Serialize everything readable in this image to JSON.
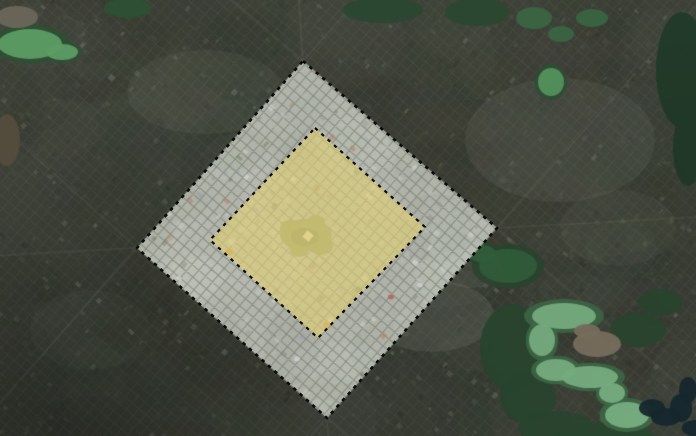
{
  "view": {
    "width": 696,
    "height": 436
  },
  "palette": {
    "base": "#3c4037",
    "base_mottle": [
      "#31352b",
      "#474b41",
      "#3a4434",
      "#4c483c",
      "#2c3028",
      "#555a50",
      "#434735"
    ],
    "outside_speckle": [
      "#4b5045",
      "#41463c",
      "#565b50",
      "#353a30",
      "#60655a",
      "#2d322a",
      "#50544a",
      "#474b41",
      "#7a7e72",
      "#3e4a3a"
    ],
    "street_outside": "rgba(160,164,152,0.10)",
    "avenue": "rgba(168,171,158,0.10)",
    "light_patch": "#a3a79a",
    "ring_fill": "#b0b4aa",
    "ring_mottle": [
      "#c6cabf",
      "#a3a79b",
      "#d2d5cc",
      "#969a8e"
    ],
    "ring_speckle": [
      "#d7d9d1",
      "#c6c9c0",
      "#b7bab0",
      "#9da196",
      "#8b8f84",
      "#e2e4dd",
      "#7f8478",
      "#cdd0c7",
      "#a9ad9f",
      "#8e99a8",
      "#b3785f",
      "#6f7a64"
    ],
    "street_ring": "rgba(95,100,88,0.50)",
    "warm_speckle": [
      "#e1d9a4",
      "#cdc383",
      "#c0b778",
      "#d9d098",
      "#b5ab6e",
      "#e8e2b0"
    ],
    "boundary": "#0a0a0a",
    "park_fill": "#8e9768",
    "park_core": "#7d875b",
    "park_plaza": "#d6d2a8"
  },
  "boundaries": {
    "outer": {
      "vertices": [
        [
          303,
          61
        ],
        [
          497,
          228
        ],
        [
          327,
          418
        ],
        [
          137,
          248
        ]
      ]
    },
    "highlight": {
      "vertices": [
        [
          315,
          128
        ],
        [
          425,
          227
        ],
        [
          318,
          338
        ],
        [
          210,
          240
        ]
      ]
    }
  },
  "overlay": {
    "highlight_fill": "#e4d275",
    "highlight_opacity": 0.6,
    "stroke": "#0a0a0a",
    "dash": "3.5 5",
    "outer_width": 2.6,
    "highlight_width": 2.2
  },
  "texture": {
    "seed": 1337,
    "grid_spacing": 9,
    "mottle_count": 380,
    "ring_mottle_count": 130,
    "speckle_outside": 4200,
    "speckle_ring": 2600,
    "speckle_warm": 1200
  },
  "features": {
    "green": [
      {
        "name": "lake-top-left",
        "parts": [
          [
            30,
            44,
            32,
            15
          ],
          [
            62,
            52,
            16,
            8
          ]
        ],
        "fill": "#5d9c64",
        "rim": "#2d5034"
      },
      {
        "name": "forest-top-left",
        "parts": [
          [
            128,
            8,
            24,
            10
          ]
        ],
        "fill": "#2d5034"
      },
      {
        "name": "forest-top-center",
        "parts": [
          [
            383,
            10,
            40,
            13
          ]
        ],
        "fill": "#2a4830"
      },
      {
        "name": "forest-top-center-2",
        "parts": [
          [
            477,
            12,
            32,
            14
          ]
        ],
        "fill": "#2a4830"
      },
      {
        "name": "pond-top-right",
        "parts": [
          [
            551,
            82,
            13,
            14
          ]
        ],
        "fill": "#55945e",
        "rim": "#2d5034"
      },
      {
        "name": "fields-top-right",
        "parts": [
          [
            534,
            18,
            18,
            11
          ],
          [
            561,
            34,
            13,
            8
          ],
          [
            592,
            18,
            16,
            9
          ]
        ],
        "fill": "#3a6543"
      },
      {
        "name": "forest-right-edge",
        "parts": [
          [
            682,
            70,
            26,
            58
          ],
          [
            688,
            148,
            15,
            38
          ]
        ],
        "fill": "#223b29"
      },
      {
        "name": "field-right-mid",
        "parts": [
          [
            508,
            266,
            29,
            17
          ],
          [
            483,
            254,
            13,
            9
          ]
        ],
        "fill": "#33613d",
        "rim": "#2a4830"
      },
      {
        "name": "wetland-bottom-right",
        "parts": [
          [
            512,
            348,
            32,
            44
          ],
          [
            528,
            398,
            28,
            25
          ],
          [
            556,
            428,
            38,
            17
          ],
          [
            638,
            330,
            28,
            17
          ],
          [
            660,
            302,
            22,
            13
          ],
          [
            604,
            436,
            50,
            14
          ]
        ],
        "fill": "#2a4830"
      },
      {
        "name": "lake-bottom-right",
        "parts": [
          [
            564,
            316,
            32,
            13
          ],
          [
            542,
            340,
            13,
            16
          ],
          [
            556,
            370,
            20,
            11
          ],
          [
            590,
            377,
            28,
            11
          ],
          [
            612,
            393,
            13,
            10
          ],
          [
            627,
            415,
            22,
            13
          ]
        ],
        "fill": "#7cb486",
        "rim": "#3f6e49"
      },
      {
        "name": "river-bottom-right",
        "parts": [
          [
            652,
            408,
            13,
            9
          ],
          [
            666,
            417,
            15,
            9
          ],
          [
            681,
            408,
            11,
            14
          ],
          [
            688,
            390,
            9,
            13
          ],
          [
            694,
            428,
            12,
            8
          ]
        ],
        "fill": "#16282e"
      },
      {
        "name": "clearing-bottom-right",
        "parts": [
          [
            597,
            344,
            24,
            13
          ],
          [
            587,
            331,
            13,
            7
          ]
        ],
        "fill": "#7d7362"
      },
      {
        "name": "field-left-edge",
        "parts": [
          [
            7,
            140,
            13,
            26
          ]
        ],
        "fill": "#544c3d"
      },
      {
        "name": "clearing-top-left",
        "parts": [
          [
            17,
            17,
            21,
            11
          ]
        ],
        "fill": "#6a675a"
      }
    ],
    "light_patches": [
      [
        560,
        140,
        95,
        62,
        0.1
      ],
      [
        432,
        316,
        62,
        36,
        0.15
      ],
      [
        472,
        266,
        38,
        22,
        0.13
      ],
      [
        205,
        92,
        78,
        42,
        0.08
      ],
      [
        618,
        228,
        58,
        38,
        0.07
      ],
      [
        90,
        330,
        60,
        40,
        0.05
      ]
    ],
    "vignettes": [
      [
        70,
        432,
        260,
        0.22
      ],
      [
        350,
        444,
        430,
        0.1
      ],
      [
        690,
        200,
        230,
        0.08
      ],
      [
        8,
        430,
        160,
        0.12
      ]
    ],
    "park": {
      "parts": [
        [
          306,
          235,
          26,
          16
        ],
        [
          290,
          228,
          10,
          8
        ],
        [
          321,
          246,
          12,
          9
        ],
        [
          299,
          250,
          9,
          7
        ],
        [
          316,
          222,
          9,
          7
        ]
      ],
      "core": [
        305,
        237,
        14,
        9
      ],
      "plaza": [
        308,
        236,
        8
      ]
    },
    "roofs": [
      [
        229,
        252,
        4,
        "#c08a49"
      ],
      [
        327,
        325,
        4,
        "#c08a49"
      ],
      [
        391,
        297,
        3,
        "#b4675a"
      ],
      [
        297,
        359,
        3,
        "#cccccc"
      ],
      [
        420,
        285,
        3,
        "#cccccc"
      ],
      [
        255,
        210,
        3,
        "#8fa2b5"
      ]
    ]
  }
}
